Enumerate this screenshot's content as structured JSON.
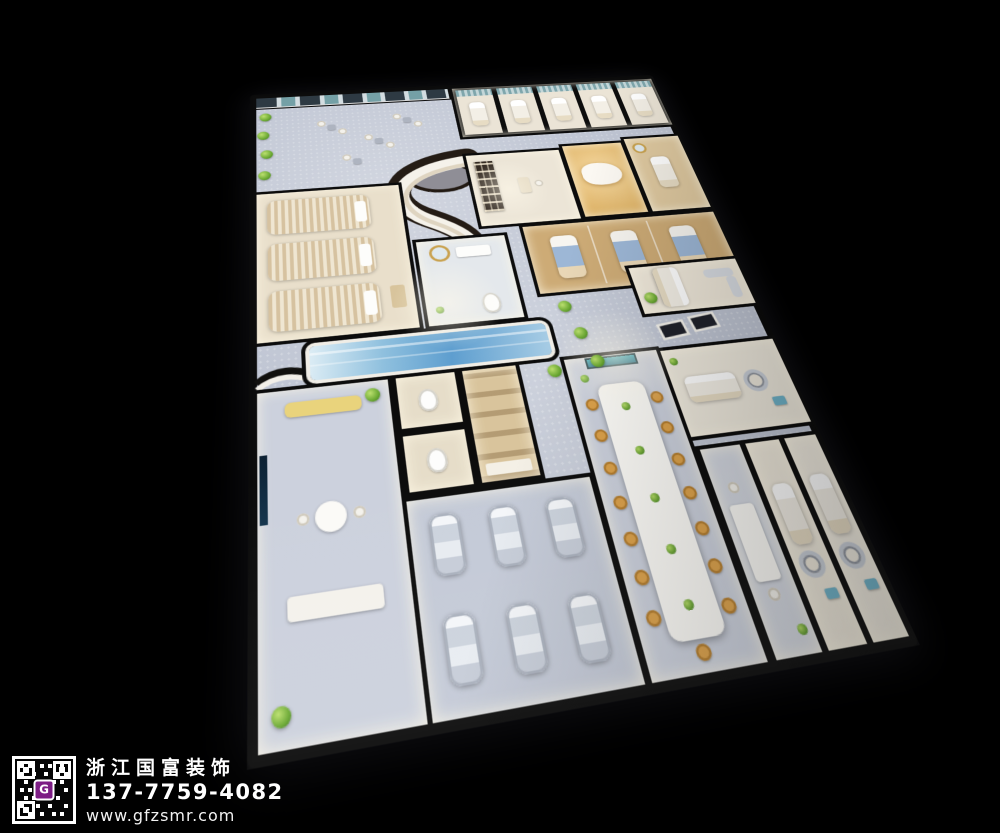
{
  "brand": {
    "company_name": "浙江国富装饰",
    "phone": "137-7759-4082",
    "website": "www.gfzsmr.com",
    "qr_logo_letter": "G"
  },
  "colors": {
    "background": "#000000",
    "wall": "#0c0c0c",
    "floor_cool_gray": "#c2c7d5",
    "floor_cream": "#ece5d7",
    "wood": "#cdab76",
    "teal_curtain": "#7fa6ac",
    "blue_bed": "#9db7d6",
    "orange_chair": "#dda24a",
    "plant_green": "#6aa832",
    "water_blue": "#5e9ecf",
    "qr_logo_purple": "#7d1d85",
    "text_white": "#ffffff"
  }
}
